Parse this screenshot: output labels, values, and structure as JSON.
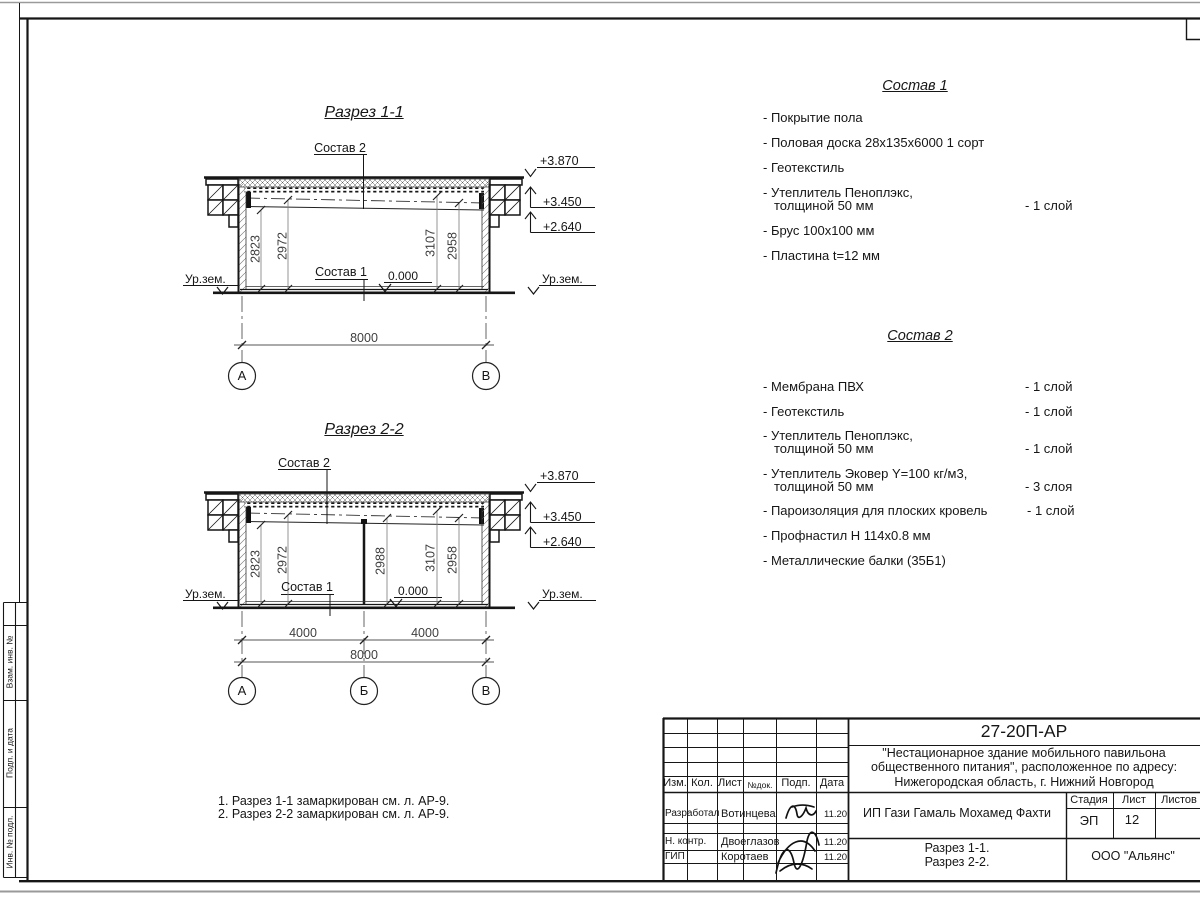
{
  "section1": {
    "title": "Разрез 1-1",
    "sostav2_label": "Состав 2",
    "sostav1_label": "Состав 1",
    "zero_level": "0.000",
    "ground_left": "Ур.зем.",
    "ground_right": "Ур.зем.",
    "elev_top": "+3.870",
    "elev_mid": "+3.450",
    "elev_low": "+2.640",
    "dim1": "2823",
    "dim2": "2972",
    "dim3": "3107",
    "dim4": "2958",
    "dim_total": "8000",
    "axis_left": "А",
    "axis_right": "В"
  },
  "section2": {
    "title": "Разрез 2-2",
    "sostav2_label": "Состав 2",
    "sostav1_label": "Состав 1",
    "zero_level": "0.000",
    "ground_left": "Ур.зем.",
    "ground_right": "Ур.зем.",
    "elev_top": "+3.870",
    "elev_mid": "+3.450",
    "elev_low": "+2.640",
    "dim1": "2823",
    "dim2": "2972",
    "dim_mid": "2988",
    "dim3": "3107",
    "dim4": "2958",
    "dim_span_left": "4000",
    "dim_span_right": "4000",
    "dim_total": "8000",
    "axis_left": "А",
    "axis_mid": "Б",
    "axis_right": "В"
  },
  "lists": {
    "sostav1": {
      "title": "Состав 1",
      "items": [
        {
          "line1": "- Покрытие пола"
        },
        {
          "line1": "- Половая доска 28х135х6000 1 сорт"
        },
        {
          "line1": "- Геотекстиль"
        },
        {
          "line1": "- Утеплитель Пеноплэкс,",
          "line2": "толщиной 50 мм",
          "qty": "- 1 слой"
        },
        {
          "line1": "- Брус 100х100 мм"
        },
        {
          "line1": "- Пластина t=12 мм"
        }
      ]
    },
    "sostav2": {
      "title": "Состав 2",
      "items": [
        {
          "line1": "- Мембрана ПВХ",
          "qty": "- 1 слой"
        },
        {
          "line1": "- Геотекстиль",
          "qty": "- 1 слой"
        },
        {
          "line1": "- Утеплитель Пеноплэкс,",
          "line2": "толщиной 50 мм",
          "qty": "- 1 слой"
        },
        {
          "line1": "- Утеплитель Эковер Y=100 кг/м3,",
          "line2": "толщиной 50 мм",
          "qty": "- 3 слоя"
        },
        {
          "line1": "- Пароизоляция для плоских кровель",
          "qty": "- 1 слой"
        },
        {
          "line1": "- Профнастил Н 114х0.8 мм"
        },
        {
          "line1": "- Металлические балки (35Б1)"
        }
      ]
    }
  },
  "notes": {
    "n1": "1. Разрез 1-1 замаркирован см. л. АР-9.",
    "n2": "2. Разрез 2-2 замаркирован см. л. АР-9."
  },
  "titleblock": {
    "doc_code": "27-20П-АР",
    "project_line1": "\"Нестационарное здание мобильного павильона",
    "project_line2": "общественного питания\", расположенное по адресу:",
    "project_line3": "Нижегородская область, г. Нижний Новгород",
    "client": "ИП Гази Гамаль Мохамед Фахти",
    "sheet_title_line1": "Разрез 1-1.",
    "sheet_title_line2": "Разрез 2-2.",
    "company": "ООО \"Альянс\"",
    "stage_label": "Стадия",
    "sheet_label": "Лист",
    "sheets_label": "Листов",
    "stage_value": "ЭП",
    "sheet_value": "12",
    "cols": {
      "izm": "Изм.",
      "kol": "Кол.",
      "list": "Лист",
      "doc": "№док.",
      "podp": "Подп.",
      "data": "Дата"
    },
    "rows": [
      {
        "role": "Разработал",
        "name": "Вотинцева",
        "date": "11.20"
      },
      {
        "role": "Н. контр.",
        "name": "Двоеглазов",
        "date": "11.20"
      },
      {
        "role": "ГИП",
        "name": "Коротаев",
        "date": "11.20"
      }
    ]
  },
  "side_stamp": {
    "r1": "Взам. инв. №",
    "r2": "Подп. и дата",
    "r3": "Инв. № подл."
  }
}
